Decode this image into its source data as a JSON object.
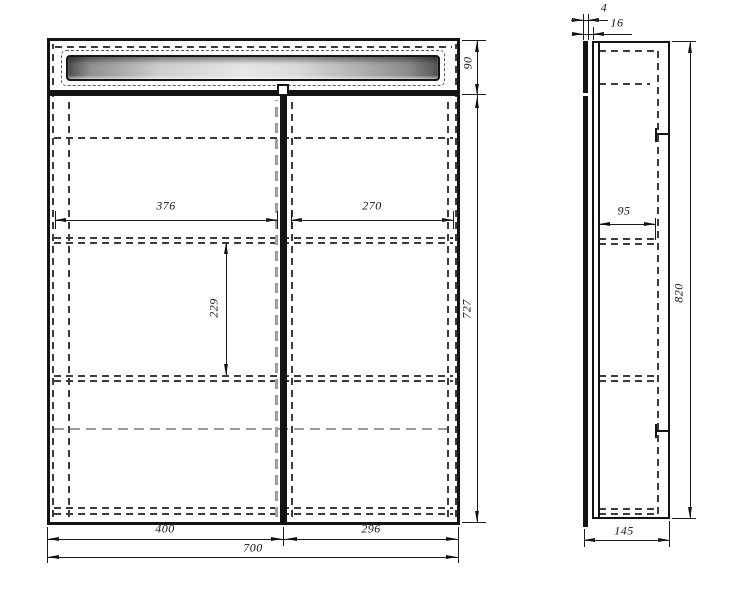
{
  "drawing": {
    "title": "two-door mirrored cabinet technical drawing",
    "front_view": {
      "dims": {
        "interior_left_width": "376",
        "interior_right_width": "270",
        "shelf_spacing": "229",
        "top_section_height": "90",
        "body_height": "727",
        "left_door_width": "400",
        "right_door_width": "296",
        "total_width": "700"
      }
    },
    "side_view": {
      "dims": {
        "door_thickness": "4",
        "front_offset": "16",
        "shelf_depth": "95",
        "total_height": "820",
        "total_depth": "145"
      }
    },
    "colors": {
      "line": "#141414",
      "dashed": "#3c3c3c",
      "background": "#ffffff"
    }
  }
}
